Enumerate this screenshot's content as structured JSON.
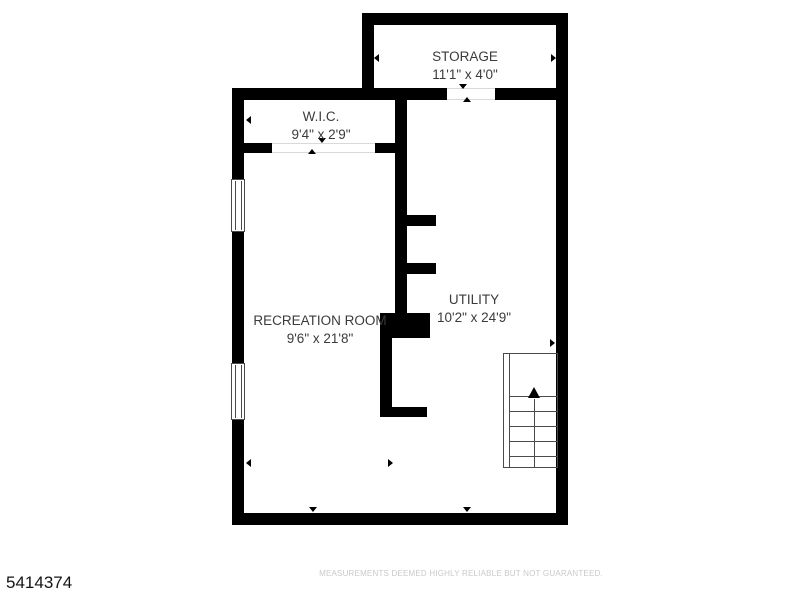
{
  "meta": {
    "listing_number": "5414374",
    "disclaimer": "MEASUREMENTS DEEMED HIGHLY RELIABLE BUT NOT GUARANTEED."
  },
  "rooms": [
    {
      "id": "storage",
      "name": "STORAGE",
      "dimensions": "11'1\" x 4'0\""
    },
    {
      "id": "wic",
      "name": "W.I.C.",
      "dimensions": "9'4\" x 2'9\""
    },
    {
      "id": "recreation",
      "name": "RECREATION ROOM",
      "dimensions": "9'6\" x 21'8\""
    },
    {
      "id": "utility",
      "name": "UTILITY",
      "dimensions": "10'2\" x 24'9\""
    }
  ],
  "colors": {
    "wall": "#000000",
    "label_text": "#3b3b3b",
    "disclaimer_text": "#c9c9c9",
    "background": "#ffffff"
  }
}
